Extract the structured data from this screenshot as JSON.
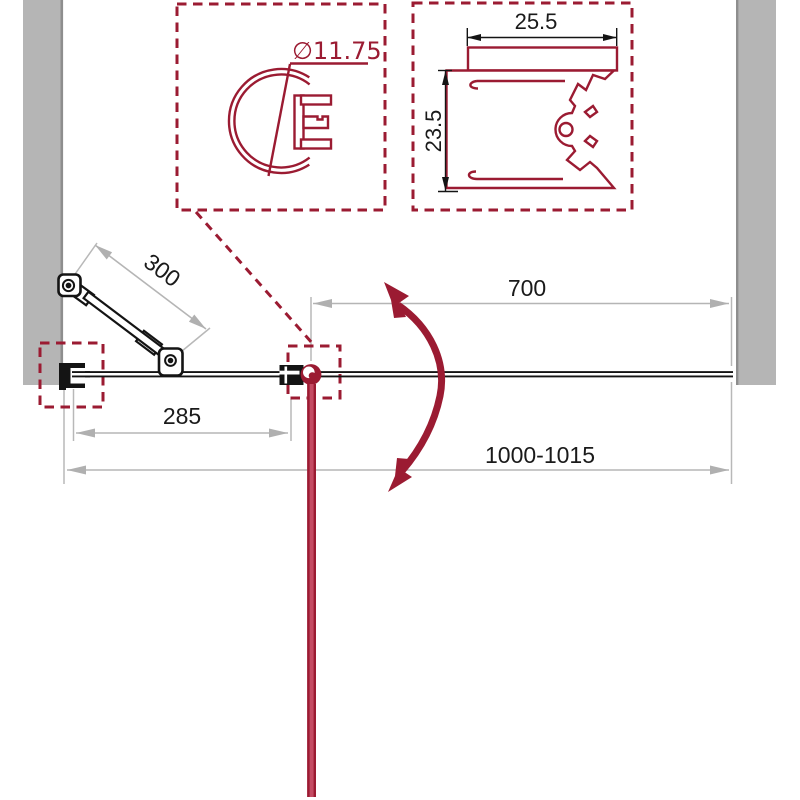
{
  "drawing": {
    "detail_round_profile": {
      "diameter_label": "∅11.75"
    },
    "detail_wall_profile": {
      "width_label": "25.5",
      "height_label": "23.5"
    },
    "plan": {
      "support_arm_length": "300",
      "fixed_section_width": "285",
      "door_section_width": "700",
      "total_width_range": "1000-1015"
    },
    "colors": {
      "accent_red": "#9B1B32",
      "door_fill_red": "#C44B63",
      "wall_gray": "#B5B5B5",
      "dimension_gray": "#B3B3B3",
      "line_black": "#141414"
    }
  }
}
